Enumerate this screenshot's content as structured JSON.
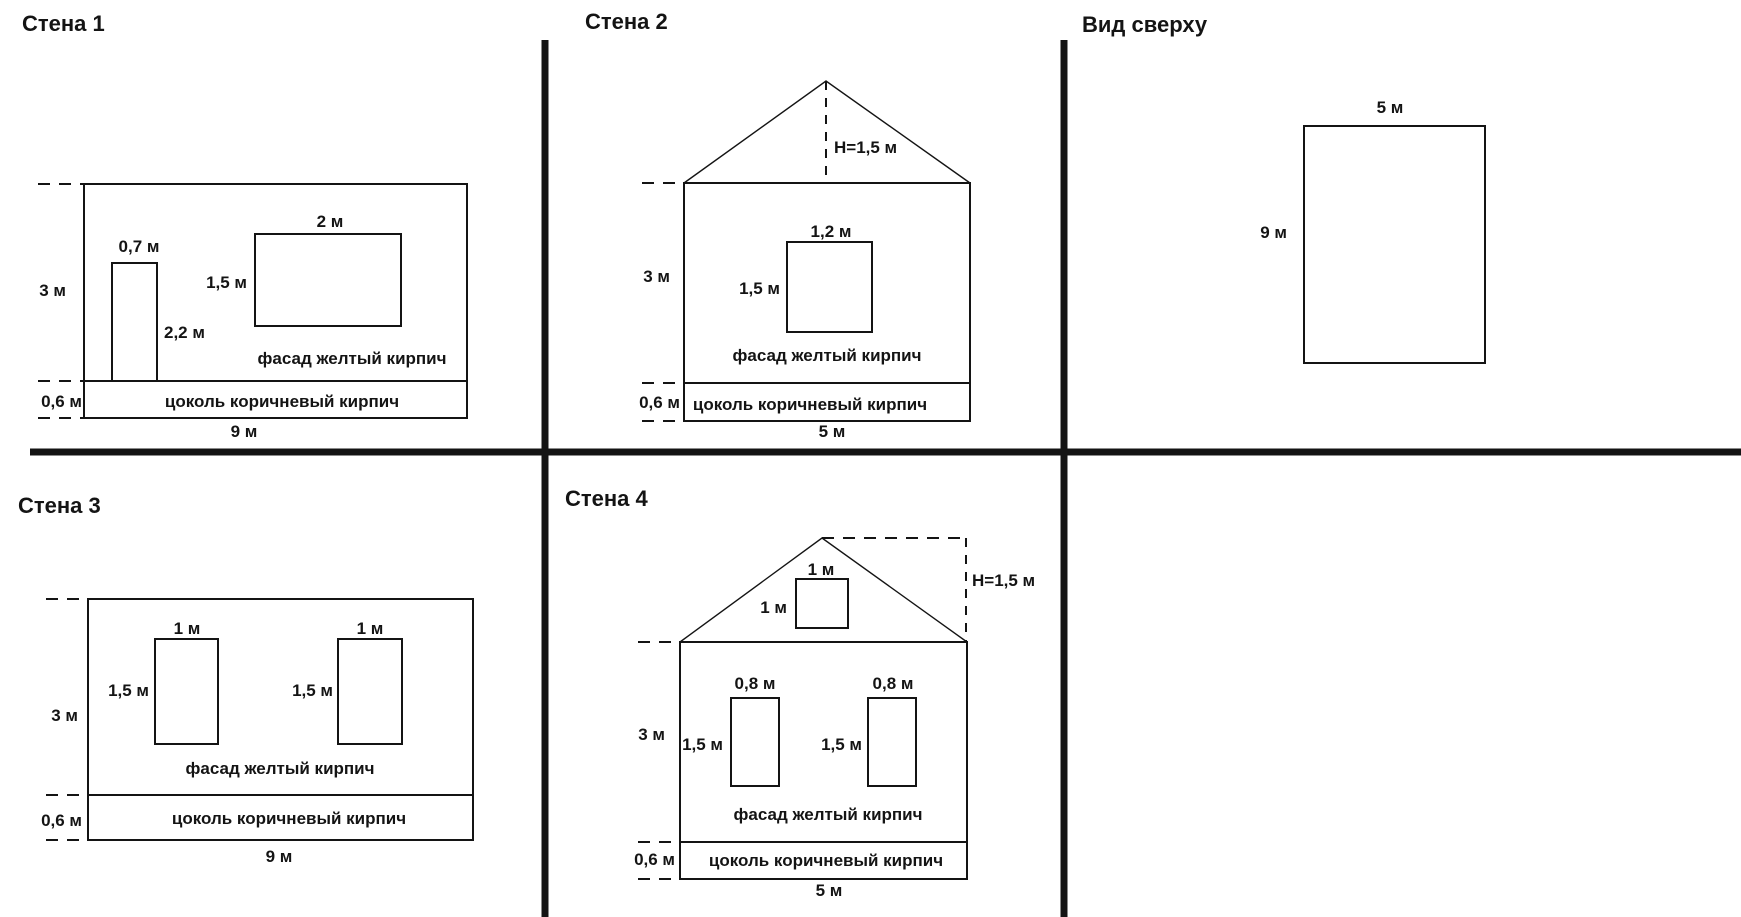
{
  "canvas": {
    "background": "#ffffff",
    "line_color": "#141414",
    "text_color": "#141414",
    "width_px": 1741,
    "height_px": 917
  },
  "panels": {
    "wall1": {
      "title": "Стена 1",
      "wall_height": "3 м",
      "wall_width": "9 м",
      "plinth_height": "0,6 м",
      "door_width": "0,7 м",
      "door_height": "2,2 м",
      "window_width": "2 м",
      "window_height": "1,5 м",
      "facade_note": "фасад желтый кирпич",
      "plinth_note": "цоколь коричневый кирпич"
    },
    "wall2": {
      "title": "Стена 2",
      "roof_height": "H=1,5 м",
      "wall_height": "3 м",
      "wall_width": "5 м",
      "plinth_height": "0,6 м",
      "window_width": "1,2 м",
      "window_height": "1,5 м",
      "facade_note": "фасад желтый кирпич",
      "plinth_note": "цоколь коричневый кирпич"
    },
    "top_view": {
      "title": "Вид сверху",
      "width": "5 м",
      "depth": "9 м"
    },
    "wall3": {
      "title": "Стена 3",
      "wall_height": "3 м",
      "wall_width": "9 м",
      "plinth_height": "0,6 м",
      "window1_width": "1 м",
      "window1_height": "1,5 м",
      "window2_width": "1 м",
      "window2_height": "1,5 м",
      "facade_note": "фасад желтый кирпич",
      "plinth_note": "цоколь коричневый кирпич"
    },
    "wall4": {
      "title": "Стена 4",
      "roof_height": "H=1,5 м",
      "gable_window_width": "1 м",
      "gable_window_height": "1 м",
      "wall_height": "3 м",
      "wall_width": "5 м",
      "plinth_height": "0,6 м",
      "window1_width": "0,8 м",
      "window1_height": "1,5 м",
      "window2_width": "0,8 м",
      "window2_height": "1,5 м",
      "facade_note": "фасад желтый кирпич",
      "plinth_note": "цоколь коричневый кирпич"
    }
  }
}
